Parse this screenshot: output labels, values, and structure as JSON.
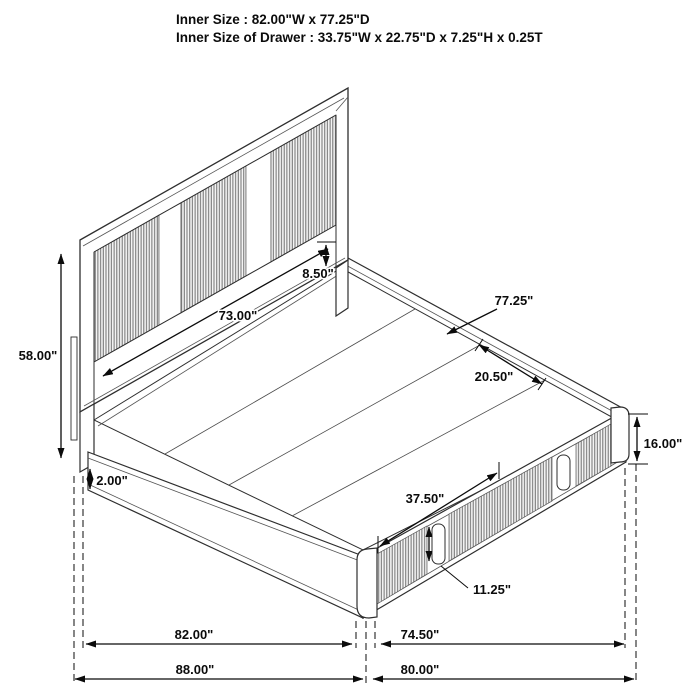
{
  "title": {
    "line1": "Inner Size : 82.00\"W x 77.25\"D",
    "line2": "Inner Size of Drawer : 33.75\"W x 22.75\"D x 7.25\"H x 0.25T"
  },
  "diagram": {
    "type": "isometric-bed-dimension-diagram",
    "subject": "storage bed with slatted headboard and two side drawers",
    "dimensions": {
      "headboard_height": "58.00\"",
      "headboard_inner_width": "73.00\"",
      "panel_to_rail_gap": "8.50\"",
      "deck_depth_inner": "77.25\"",
      "deck_plank_width": "20.50\"",
      "rail_height": "16.00\"",
      "leg_reveal": "2.00\"",
      "drawer_front_width": "37.50\"",
      "drawer_handle_height": "11.25\"",
      "width_inner": "82.00\"",
      "depth_inner": "74.50\"",
      "width_overall": "88.00\"",
      "depth_overall": "80.00\""
    },
    "line_color": "#2e2e2e",
    "slat_color": "#707070",
    "background": "#ffffff"
  }
}
